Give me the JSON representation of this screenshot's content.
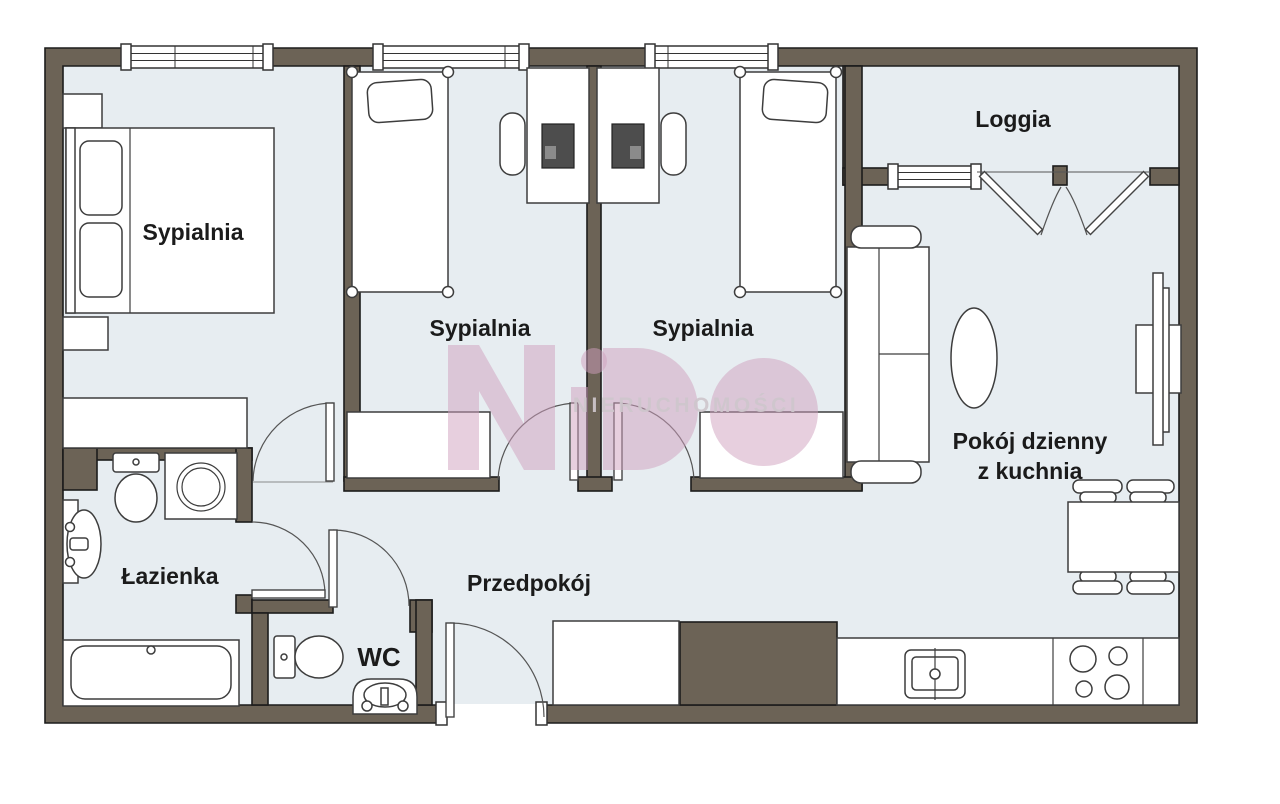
{
  "plan_title": "apartment floor plan",
  "rooms": [
    {
      "id": "sypialnia-1",
      "label": "Sypialnia"
    },
    {
      "id": "sypialnia-2",
      "label": "Sypialnia"
    },
    {
      "id": "sypialnia-3",
      "label": "Sypialnia"
    },
    {
      "id": "loggia",
      "label": "Loggia"
    },
    {
      "id": "pokoj-dzienny",
      "label_line1": "Pokój dzienny",
      "label_line2": "z kuchnia"
    },
    {
      "id": "lazienka",
      "label": "Łazienka"
    },
    {
      "id": "wc",
      "label": "WC"
    },
    {
      "id": "przedpokoj",
      "label": "Przedpokój"
    }
  ],
  "watermark": {
    "logo": "NiDO",
    "text": "NIERUCHOMOŚCI"
  },
  "colors": {
    "wall": "#6c6356",
    "floor": "#e7edf1",
    "outline": "#1c1c1c",
    "furniture_stroke": "#3d3d3d",
    "label": "#1b1b1b",
    "watermark_pink": "#cf9fbe",
    "watermark_text": "#cfc7cd",
    "monitor": "#4d4d4d"
  }
}
